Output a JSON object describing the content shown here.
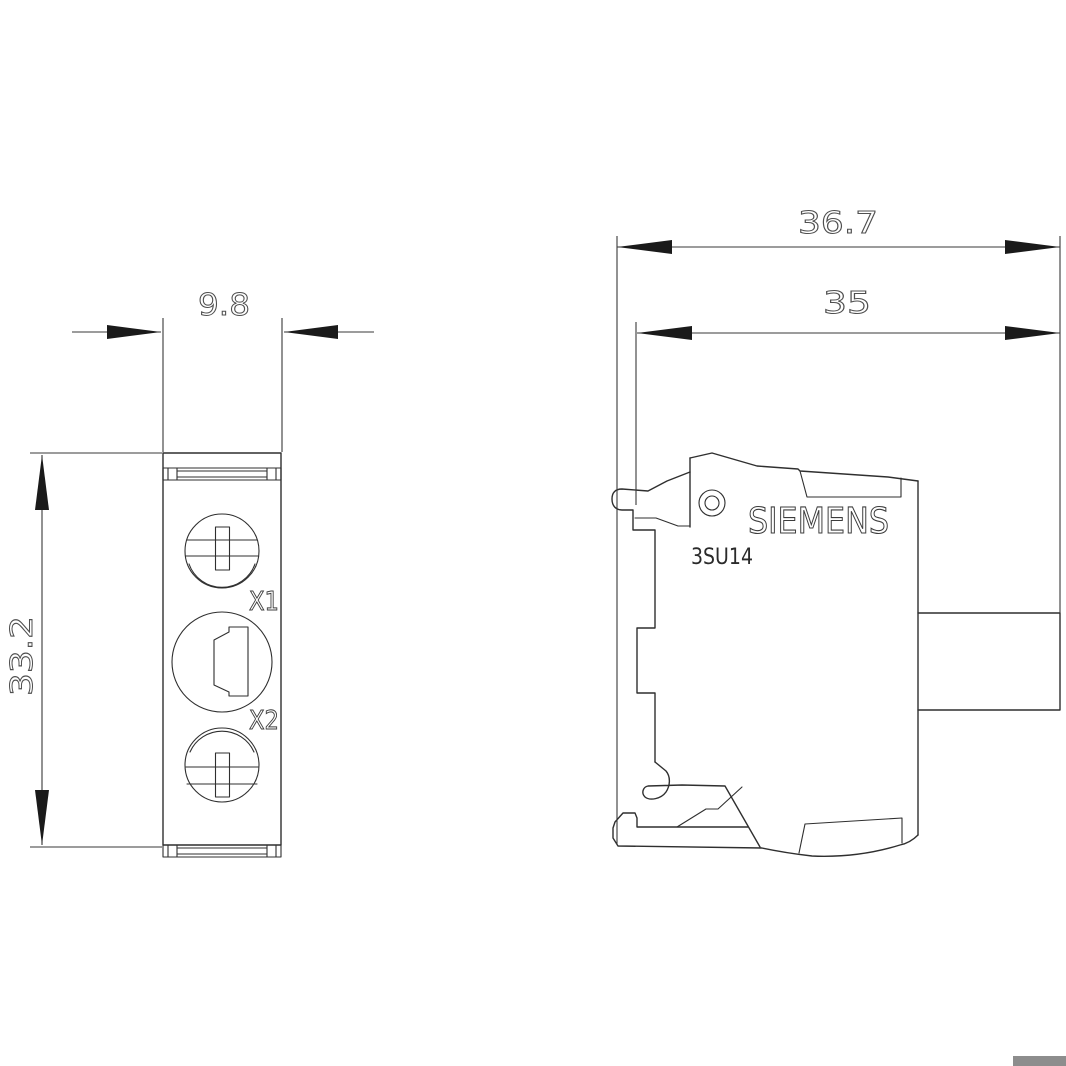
{
  "page": {
    "background": "#ffffff",
    "corner_marker_color": "#8d8d8d"
  },
  "drawing": {
    "views": {
      "front": {
        "terminals": {
          "top": "X1",
          "bottom": "X2"
        }
      },
      "side": {
        "brand": "SIEMENS",
        "model": "3SU14"
      }
    },
    "dimensions_mm": {
      "front_width": "9.8",
      "front_height": "33.2",
      "side_overall_depth": "36.7",
      "side_body_depth": "35"
    },
    "style": {
      "line_color": "#2f2f2f",
      "dimension_color": "#4f4f4f",
      "arrow_color": "#1a1a1a"
    }
  }
}
